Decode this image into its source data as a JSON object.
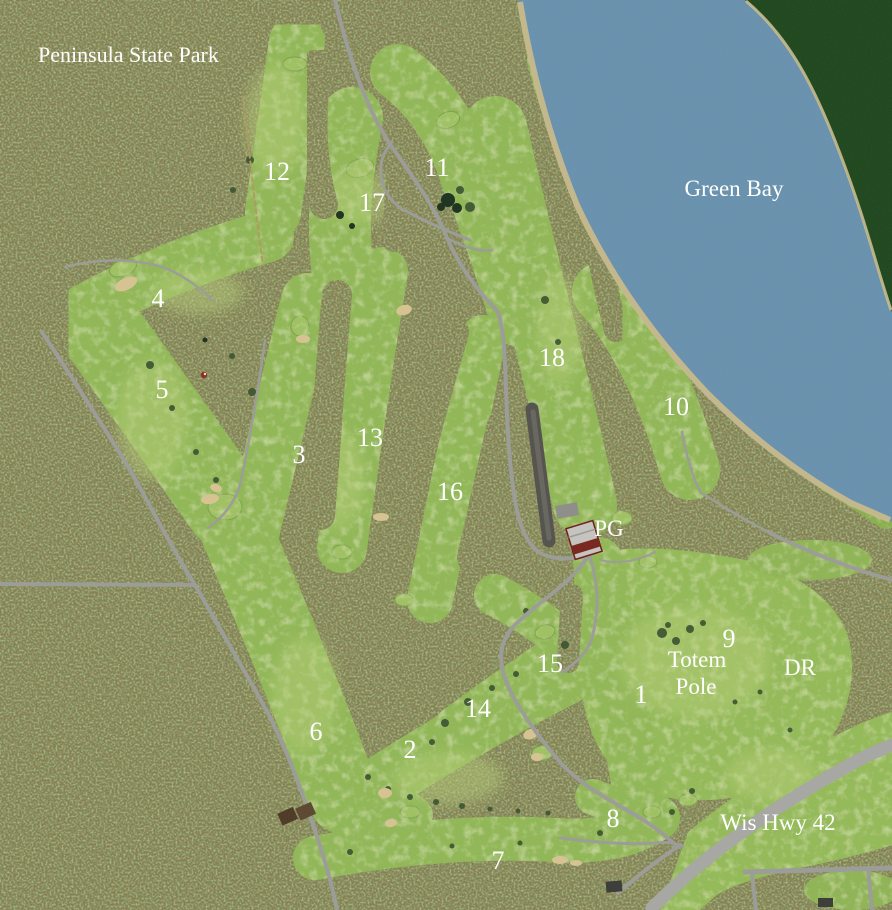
{
  "map": {
    "park_label": "Peninsula State Park",
    "water_label": "Green Bay",
    "highway_label": "Wis Hwy 42",
    "pro_shop_label": "PG",
    "driving_range_label": "DR",
    "totem_pole_line1": "Totem",
    "totem_pole_line2": "Pole",
    "hole_numbers": [
      "1",
      "2",
      "3",
      "4",
      "5",
      "6",
      "7",
      "8",
      "9",
      "10",
      "11",
      "12",
      "13",
      "14",
      "15",
      "16",
      "17",
      "18"
    ],
    "colors": {
      "water": "#6992ae",
      "far_shore_green": "#20481f",
      "forest_base": "#8b7a4d",
      "fairway_green": "#91b757",
      "putting_green": "#a0c164",
      "bunker_sand": "#d7c392",
      "shore_sand": "#c8b98b",
      "road_gray": "#9c9c98",
      "parking_dark": "#54534e",
      "label_white": "#ffffff"
    }
  }
}
